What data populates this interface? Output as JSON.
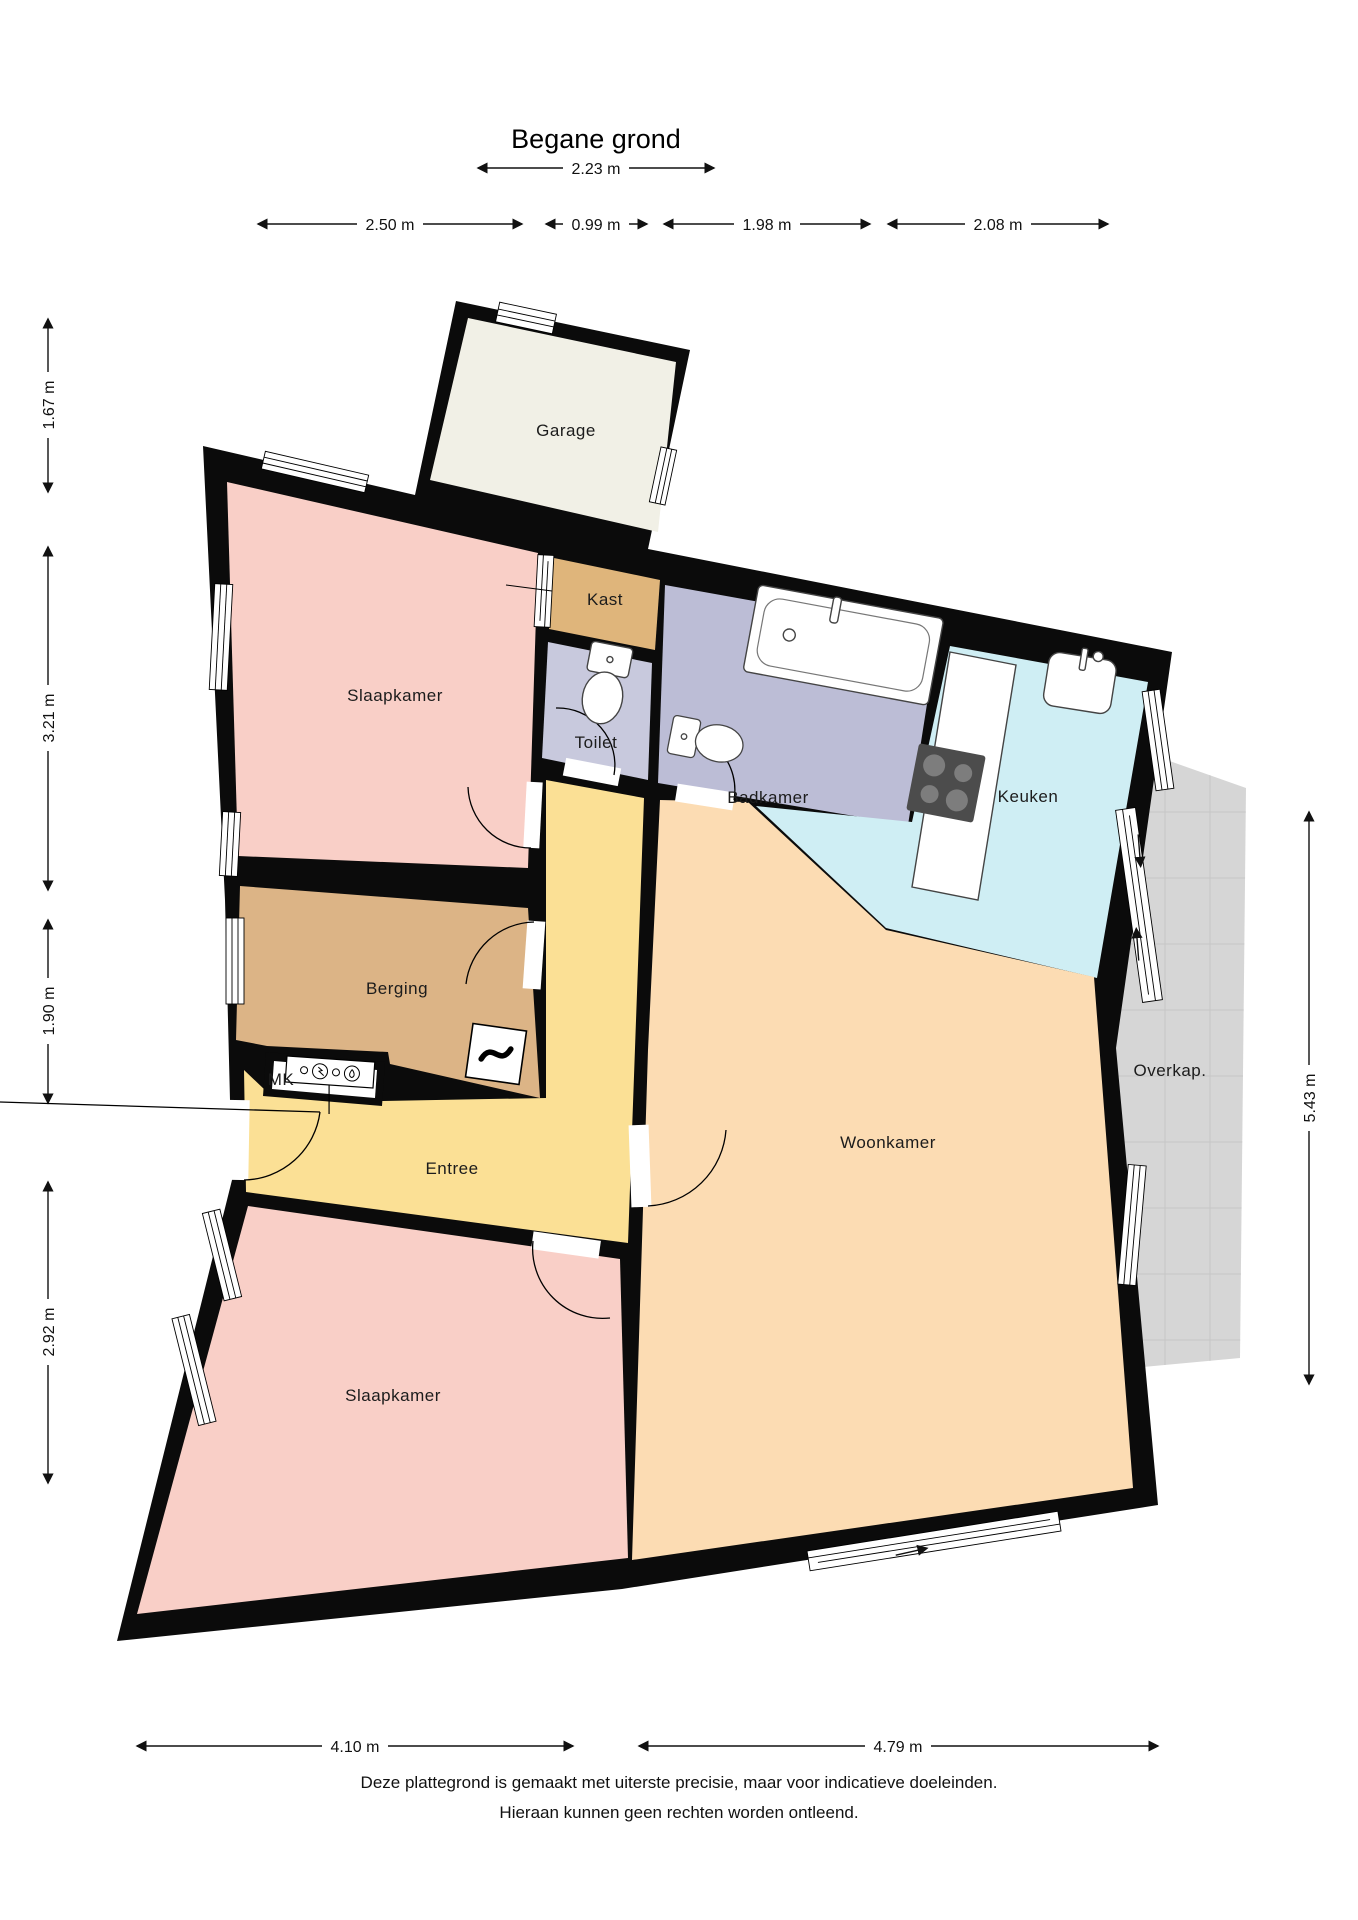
{
  "title": "Begane grond",
  "rooms": {
    "garage": {
      "label": "Garage",
      "color": "#f1f0e6"
    },
    "kast": {
      "label": "Kast",
      "color": "#dfb57b"
    },
    "slaapkamer1": {
      "label": "Slaapkamer",
      "color": "#f9cfc7"
    },
    "toilet": {
      "label": "Toilet",
      "color": "#c8c9dd"
    },
    "badkamer": {
      "label": "Badkamer",
      "color": "#bcbdd6"
    },
    "keuken": {
      "label": "Keuken",
      "color": "#cfeef4"
    },
    "berging": {
      "label": "Berging",
      "color": "#dcb486"
    },
    "meterkast": {
      "label": "MK",
      "color": "#ffffff"
    },
    "entree": {
      "label": "Entree",
      "color": "#fbe095"
    },
    "woonkamer": {
      "label": "Woonkamer",
      "color": "#fcdcb3"
    },
    "slaapkamer2": {
      "label": "Slaapkamer",
      "color": "#f9cfc7"
    },
    "overkapping": {
      "label": "Overkap.",
      "color": "#d6d6d6"
    }
  },
  "dimensions": {
    "top_garage": {
      "label": "2.23 m"
    },
    "top_row": [
      {
        "label": "2.50 m"
      },
      {
        "label": "0.99 m"
      },
      {
        "label": "1.98 m"
      },
      {
        "label": "2.08 m"
      }
    ],
    "left": [
      {
        "label": "1.67 m"
      },
      {
        "label": "3.21 m"
      },
      {
        "label": "1.90 m"
      },
      {
        "label": "2.92 m"
      }
    ],
    "right": [
      {
        "label": "5.43 m"
      }
    ],
    "bottom": [
      {
        "label": "4.10 m"
      },
      {
        "label": "4.79 m"
      }
    ]
  },
  "footer": {
    "line1": "Deze plattegrond is gemaakt met uiterste precisie, maar voor indicatieve doeleinden.",
    "line2": "Hieraan kunnen geen rechten worden ontleend."
  },
  "colors": {
    "wall": "#0b0b0b",
    "dimension": "#111111"
  }
}
